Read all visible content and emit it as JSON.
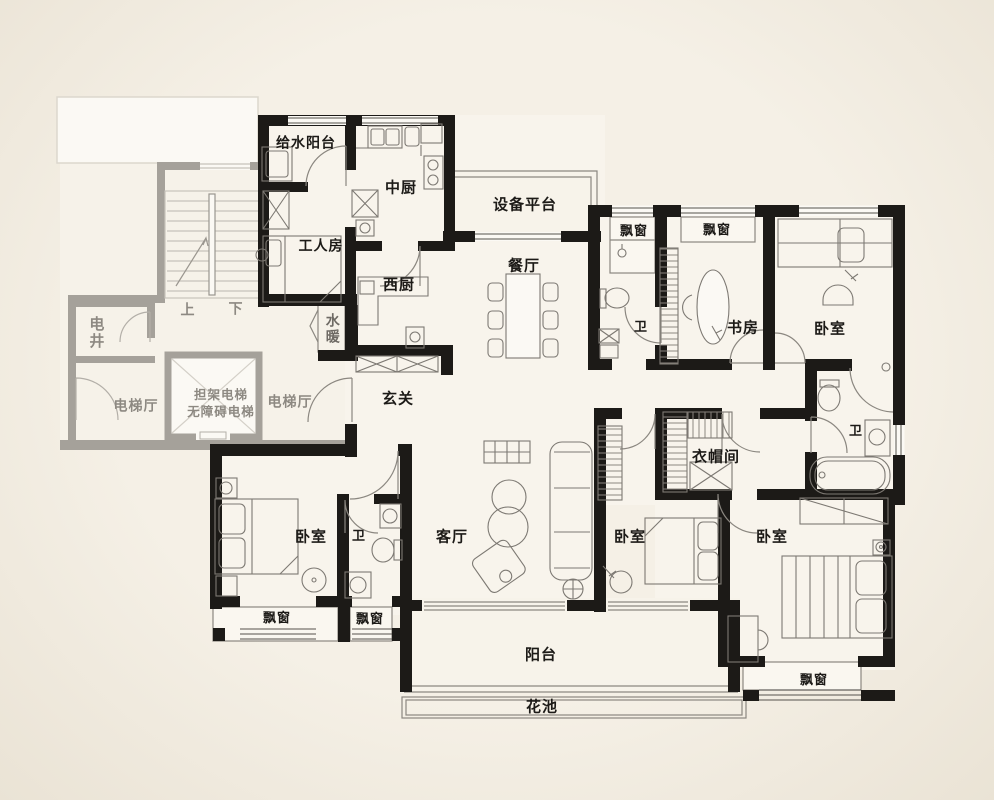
{
  "meta": {
    "type": "apartment-floor-plan",
    "language": "zh-CN"
  },
  "colors": {
    "background": "#f2ece1",
    "floor": "#f8f4ec",
    "wall": "#1c1a17",
    "common_wall": "#a5a19a",
    "line": "#8b8780",
    "label": "#1c1a17",
    "common_label": "#8d8982"
  },
  "rooms": {
    "water_supply_balcony": "给水阳台",
    "chinese_kitchen": "中厨",
    "equipment_platform": "设备平台",
    "worker_room": "工人房",
    "western_kitchen": "西厨",
    "dining_room": "餐厅",
    "bay_window": "飘窗",
    "bathroom": "卫",
    "study": "书房",
    "bedroom": "卧室",
    "foyer": "玄关",
    "cloakroom": "衣帽间",
    "living_room": "客厅",
    "balcony": "阳台",
    "flower_bed": "花池",
    "plumbing_shaft": "水暖",
    "electric_shaft": "电井",
    "elevator_hall": "电梯厅",
    "stretcher_elevator": "担架电梯",
    "accessible_elevator": "无障碍电梯",
    "stairs_up": "上",
    "stairs_down": "下"
  }
}
